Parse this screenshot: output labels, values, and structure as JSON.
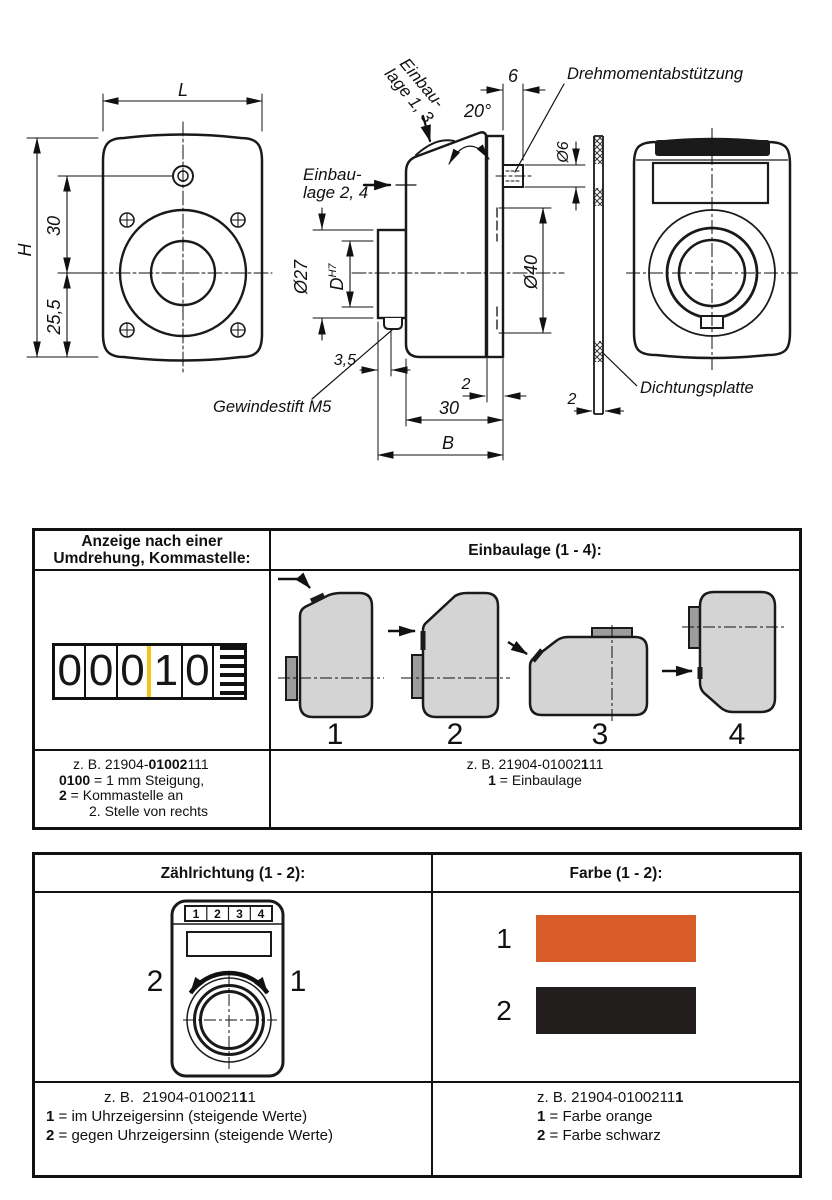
{
  "drawing": {
    "front": {
      "dim_width": "L",
      "dim_height": "H",
      "dim_screw": "30",
      "dim_center": "25,5"
    },
    "side": {
      "label_lage13_l1": "Einbau-",
      "label_lage13_l2": "lage 1, 3",
      "label_lage24_l1": "Einbau-",
      "label_lage24_l2": "lage 2, 4",
      "dim_angle": "20°",
      "dim_pin_len": "6",
      "label_torque": "Drehmomentabstützung",
      "dim_pin_dia": "Ø6",
      "dim_bore": "Ø27",
      "dim_shaft": "D",
      "dim_shaft_sup": "H7",
      "dim_plate_dia": "Ø40",
      "dim_setscrew": "3,5",
      "label_setscrew": "Gewindestift M5",
      "dim_plate_t": "2",
      "dim_body": "30",
      "dim_total": "B"
    },
    "seal": {
      "dim_thickness": "2",
      "label": "Dichtungsplatte"
    }
  },
  "table1": {
    "header_left_l1": "Anzeige nach einer",
    "header_left_l2": "Umdrehung, Kommastelle:",
    "header_right": "Einbaulage (1 - 4):",
    "counter_digits": [
      "0",
      "0",
      "0",
      "1",
      "0"
    ],
    "positions": [
      "1",
      "2",
      "3",
      "4"
    ],
    "left_text": {
      "l1a": "z. B. 21904-",
      "l1b": "01002",
      "l1c": "111",
      "l2a": "0100",
      "l2b": " = 1 mm Steigung,",
      "l3a": "2",
      "l3b": " = Kommastelle an",
      "l4": "2. Stelle von rechts"
    },
    "right_text": {
      "l1a": "z. B. 21904-01002",
      "l1b": "1",
      "l1c": "11",
      "l2a": "1",
      "l2b": " = Einbaulage"
    }
  },
  "table2": {
    "header_left": "Zählrichtung (1 - 2):",
    "header_right": "Farbe (1 - 2):",
    "device_digits": [
      "1",
      "2",
      "3",
      "4"
    ],
    "dir_left": "2",
    "dir_right": "1",
    "left_text": {
      "l1a": "z. B.  21904-010021",
      "l1b": "1",
      "l1c": "1",
      "l2a": "1",
      "l2b": " = im Uhrzeigersinn (steigende Werte)",
      "l3a": "2",
      "l3b": " = gegen Uhrzeigersinn (steigende Werte)"
    },
    "colors": [
      {
        "num": "1",
        "hex": "#d85c28"
      },
      {
        "num": "2",
        "hex": "#221e1e"
      }
    ],
    "right_text": {
      "l1a": "z. B. 21904-0100211",
      "l1b": "1",
      "l2a": "1",
      "l2b": " = Farbe orange",
      "l3a": "2",
      "l3b": " = Farbe schwarz"
    }
  }
}
